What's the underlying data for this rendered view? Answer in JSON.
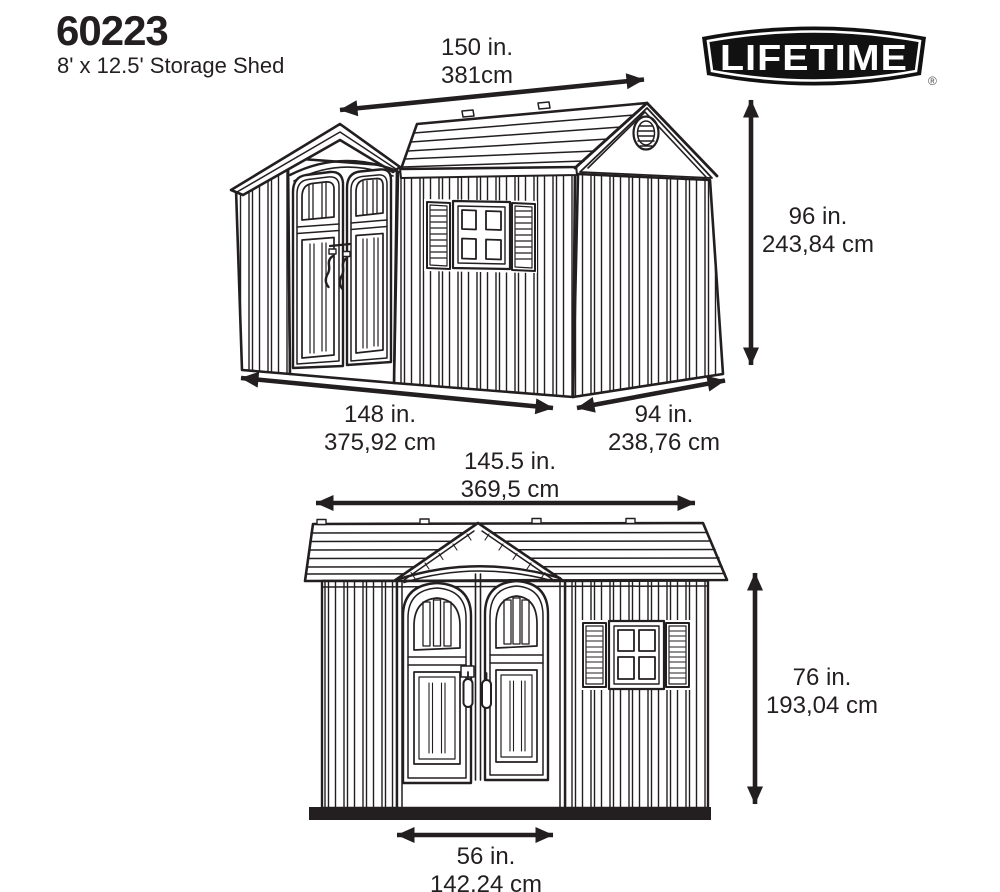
{
  "header": {
    "model_number": "60223",
    "product_name": "8' x 12.5' Storage Shed"
  },
  "brand": {
    "logo_text": "LIFETIME",
    "registered_mark": "®"
  },
  "perspective_view": {
    "roof_length_in": "150 in.",
    "roof_length_cm": "381cm",
    "height_in": "96 in.",
    "height_cm": "243,84 cm",
    "front_length_in": "148 in.",
    "front_length_cm": "375,92 cm",
    "side_depth_in": "94 in.",
    "side_depth_cm": "238,76 cm"
  },
  "front_view": {
    "width_in": "145.5 in.",
    "width_cm": "369,5 cm",
    "height_in": "76 in.",
    "height_cm": "193,04 cm",
    "door_width_in": "56 in.",
    "door_width_cm": "142,24 cm"
  },
  "colors": {
    "line_art": "#231f20",
    "background": "#ffffff",
    "logo_fill": "#111111"
  }
}
